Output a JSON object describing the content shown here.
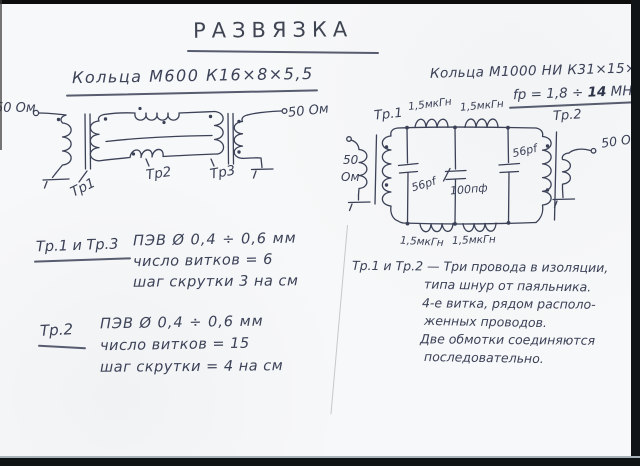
{
  "document": {
    "title": "РАЗВЯЗКА"
  },
  "left": {
    "header": "Кольца М600 К16×8×5,5",
    "circuit": {
      "impedance_left": "50 Ом",
      "impedance_right": "50 Ом",
      "tr1": "Тр1",
      "tr2": "Тр2",
      "tr3": "Тр3"
    },
    "note1": {
      "heading": "Тр.1 и Тр.3",
      "line1": "ПЭВ Ø 0,4 ÷ 0,6 мм",
      "line2": "число витков = 6",
      "line3": "шаг скрутки 3 на см"
    },
    "note2": {
      "heading": "Тр.2",
      "line1": "ПЭВ Ø 0,4 ÷ 0,6 мм",
      "line2": "число витков = 15",
      "line3": "шаг скрутки = 4 на см"
    }
  },
  "right": {
    "header": "Кольца М1000 НИ К31×15×8",
    "freq_prefix": "fр = 1,8 ÷ ",
    "freq_value": "14",
    "freq_unit": " MHz",
    "circuit": {
      "impedance_left_top": "50",
      "impedance_left_bottom": "Ом",
      "impedance_right": "50 Ом",
      "tr1": "Тр.1",
      "tr2": "Тр.2",
      "l_top1": "1,5мкГн",
      "l_top2": "1,5мкГн",
      "l_bot1": "1,5мкГн",
      "l_bot2": "1,5мкГн",
      "c1": "56pf",
      "c2": "100пф",
      "c3": "56pf"
    },
    "note": {
      "heading": "Тр.1 и Тр.2",
      "dash": " — ",
      "line1": "Три провода в изоляции,",
      "line2": "типа шнур от паяльника.",
      "line3": "4-е витка, рядом располо-",
      "line4": "женных проводов.",
      "line5": "Две обмотки соединяются",
      "line6": "последовательно."
    }
  }
}
